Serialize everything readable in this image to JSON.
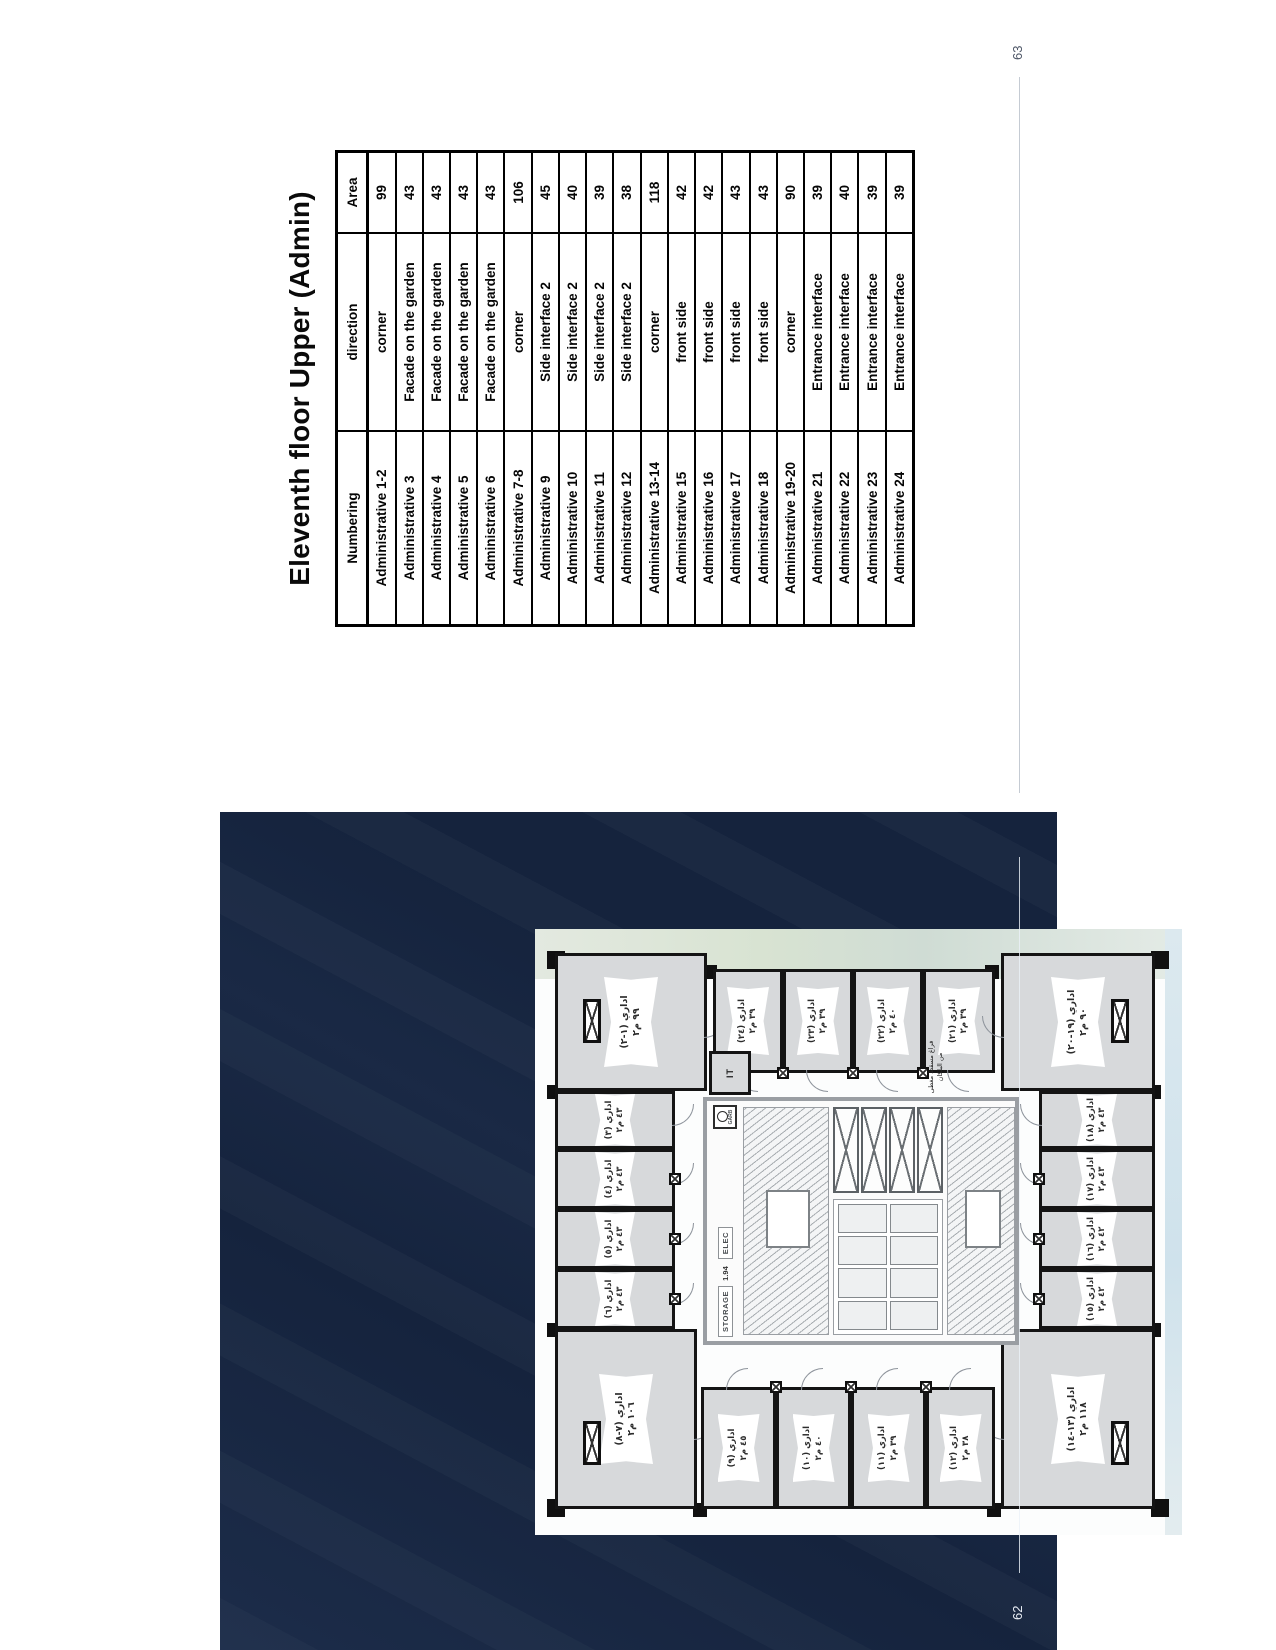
{
  "colors": {
    "panel_navy": "#15233d",
    "wall_black": "#141414",
    "room_gray": "#d7d9db"
  },
  "document": {
    "right_page": {
      "page_number": "63",
      "title": "Eleventh floor Upper (Admin)",
      "table": {
        "headers": [
          "Numbering",
          "direction",
          "Area"
        ],
        "rows": [
          [
            "Administrative 1-2",
            "corner",
            "99"
          ],
          [
            "Administrative 3",
            "Facade on the garden",
            "43"
          ],
          [
            "Administrative 4",
            "Facade on the garden",
            "43"
          ],
          [
            "Administrative 5",
            "Facade on the garden",
            "43"
          ],
          [
            "Administrative 6",
            "Facade on the garden",
            "43"
          ],
          [
            "Administrative 7-8",
            "corner",
            "106"
          ],
          [
            "Administrative 9",
            "Side interface 2",
            "45"
          ],
          [
            "Administrative 10",
            "Side interface 2",
            "40"
          ],
          [
            "Administrative 11",
            "Side interface 2",
            "39"
          ],
          [
            "Administrative 12",
            "Side interface 2",
            "38"
          ],
          [
            "Administrative 13-14",
            "corner",
            "118"
          ],
          [
            "Administrative 15",
            "front side",
            "42"
          ],
          [
            "Administrative 16",
            "front side",
            "42"
          ],
          [
            "Administrative 17",
            "front side",
            "43"
          ],
          [
            "Administrative 18",
            "front side",
            "43"
          ],
          [
            "Administrative 19-20",
            "corner",
            "90"
          ],
          [
            "Administrative 21",
            "Entrance interface",
            "39"
          ],
          [
            "Administrative 22",
            "Entrance interface",
            "40"
          ],
          [
            "Administrative 23",
            "Entrance interface",
            "39"
          ],
          [
            "Administrative 24",
            "Entrance interface",
            "39"
          ]
        ]
      }
    },
    "left_page": {
      "page_number": "62",
      "floor_plan": {
        "core": {
          "it": "IT",
          "storage": "STORAGE",
          "elec": "ELEC",
          "garb": "GARB",
          "level": "1.94",
          "note": "فراغ مسقط مغطى من البلكان"
        },
        "rooms": [
          {
            "id": "7-8",
            "label": "اداري (٧-٨)",
            "area": "١٠٦ م٢"
          },
          {
            "id": "6",
            "label": "اداري (٦)",
            "area": "٤٣ م٢"
          },
          {
            "id": "5",
            "label": "اداري (٥)",
            "area": "٤٣ م٢"
          },
          {
            "id": "4",
            "label": "اداري (٤)",
            "area": "٤٣ م٢"
          },
          {
            "id": "3",
            "label": "اداري (٣)",
            "area": "٤٣ م٢"
          },
          {
            "id": "1-2",
            "label": "اداري (١-٢)",
            "area": "٩٩ م٢"
          },
          {
            "id": "24",
            "label": "اداري (٢٤)",
            "area": "٣٩ م٢"
          },
          {
            "id": "23",
            "label": "اداري (٢٣)",
            "area": "٣٩ م٢"
          },
          {
            "id": "22",
            "label": "اداري (٢٢)",
            "area": "٤٠ م٢"
          },
          {
            "id": "21",
            "label": "اداري (٢١)",
            "area": "٣٩ م٢"
          },
          {
            "id": "19-20",
            "label": "اداري (١٩-٢٠)",
            "area": "٩٠ م٢"
          },
          {
            "id": "15",
            "label": "اداري (١٥)",
            "area": "٤٢ م٢"
          },
          {
            "id": "16",
            "label": "اداري (١٦)",
            "area": "٤٢ م٢"
          },
          {
            "id": "17",
            "label": "اداري (١٧)",
            "area": "٤٣ م٢"
          },
          {
            "id": "18",
            "label": "اداري (١٨)",
            "area": "٤٣ م٢"
          },
          {
            "id": "13-14",
            "label": "اداري (١٣-١٤)",
            "area": "١١٨ م٢"
          },
          {
            "id": "9",
            "label": "اداري (٩)",
            "area": "٤٥ م٢"
          },
          {
            "id": "10",
            "label": "اداري (١٠)",
            "area": "٤٠ م٢"
          },
          {
            "id": "11",
            "label": "اداري (١١)",
            "area": "٣٩ م٢"
          },
          {
            "id": "12",
            "label": "اداري (١٢)",
            "area": "٣٨ م٢"
          }
        ]
      }
    }
  }
}
